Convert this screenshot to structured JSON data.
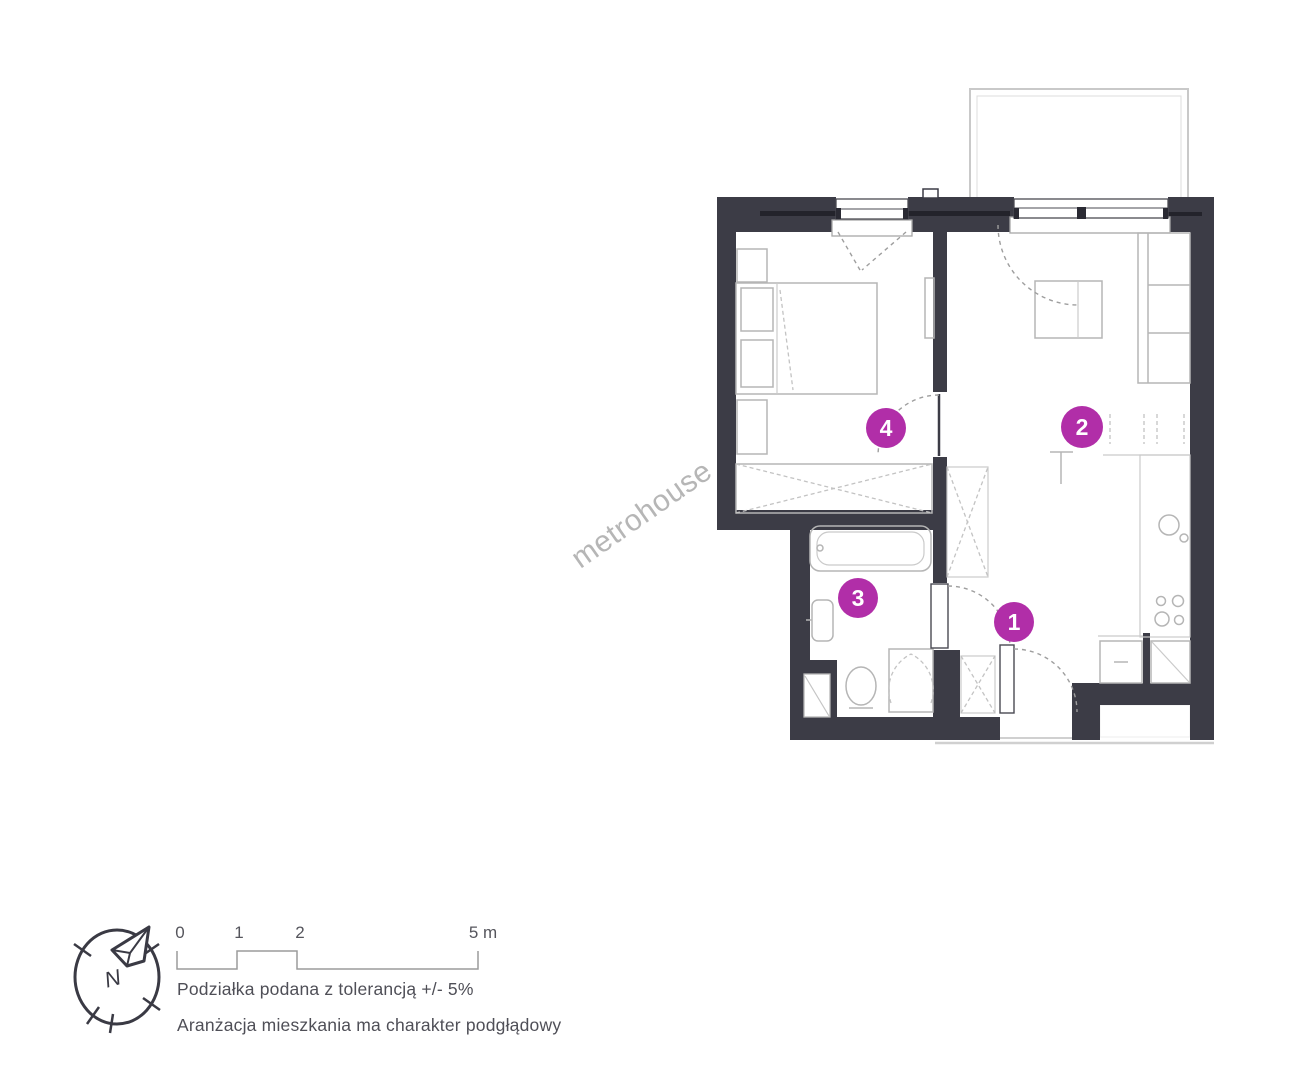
{
  "watermark": "metrohouse",
  "plan": {
    "wall_color": "#3c3c46",
    "marker_color": "#b12ea8",
    "room_markers": [
      {
        "number": "1"
      },
      {
        "number": "2"
      },
      {
        "number": "3"
      },
      {
        "number": "4"
      }
    ]
  },
  "legend": {
    "compass_label": "N",
    "scale_ticks": [
      "0",
      "1",
      "2",
      "5 m"
    ],
    "tolerance_note": "Podziałka podana z tolerancją +/- 5%",
    "arrangement_note": "Aranżacja mieszkania ma charakter podgłądowy"
  }
}
